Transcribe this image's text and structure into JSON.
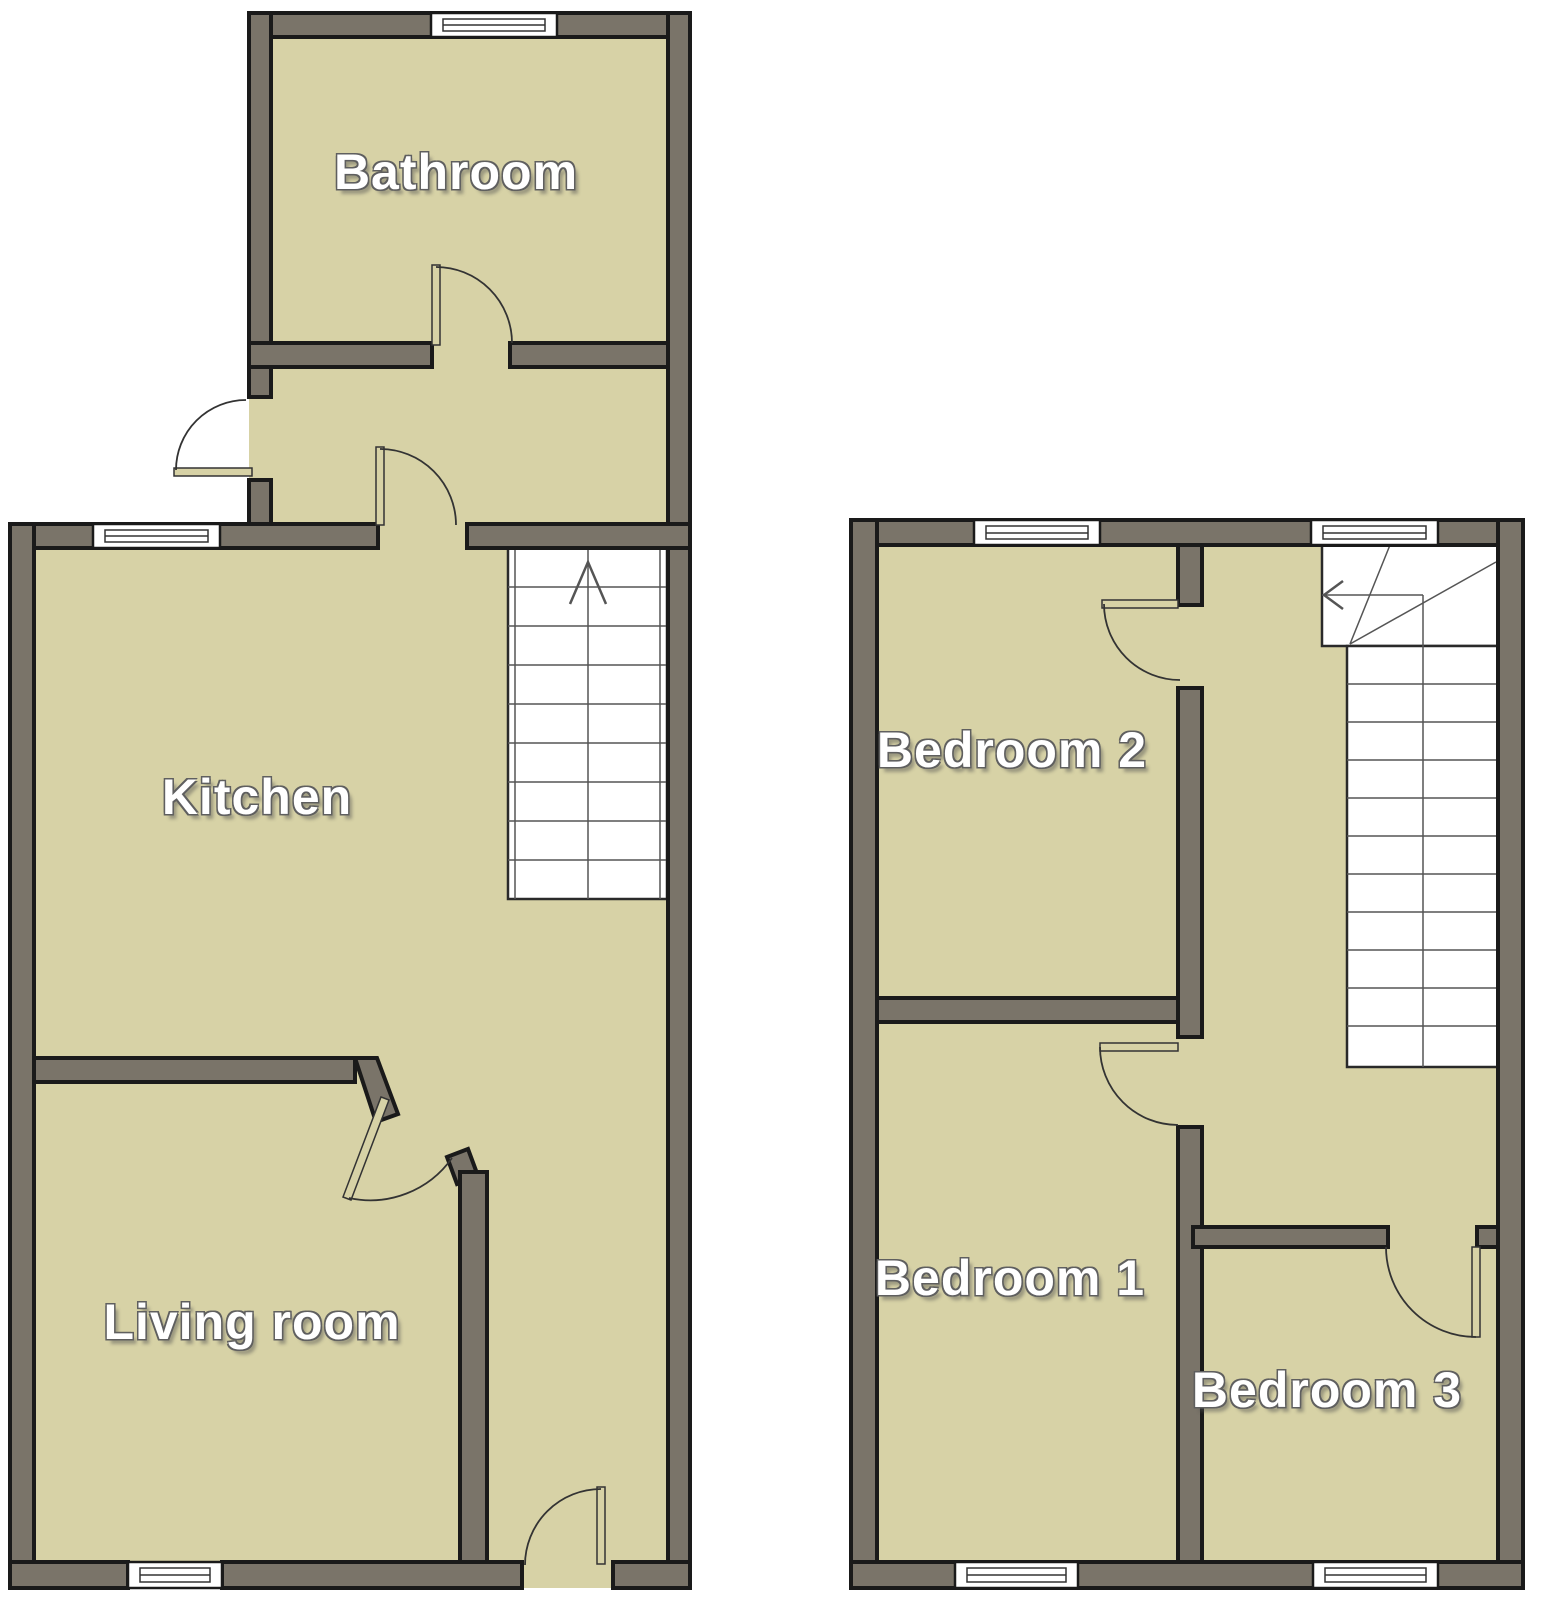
{
  "floorplan": {
    "colors": {
      "floor": "#d7d2a6",
      "wall": "#7a7469",
      "outline": "#1a1a1a",
      "stair_fill": "#ffffff",
      "door_line": "#333333",
      "label_text": "#ffffff"
    },
    "ground_floor": {
      "rooms": [
        {
          "id": "bathroom",
          "label": "Bathroom"
        },
        {
          "id": "kitchen",
          "label": "Kitchen"
        },
        {
          "id": "living-room",
          "label": "Living room"
        }
      ]
    },
    "first_floor": {
      "rooms": [
        {
          "id": "bedroom-2",
          "label": "Bedroom 2"
        },
        {
          "id": "bedroom-1",
          "label": "Bedroom 1"
        },
        {
          "id": "bedroom-3",
          "label": "Bedroom 3"
        }
      ]
    }
  }
}
